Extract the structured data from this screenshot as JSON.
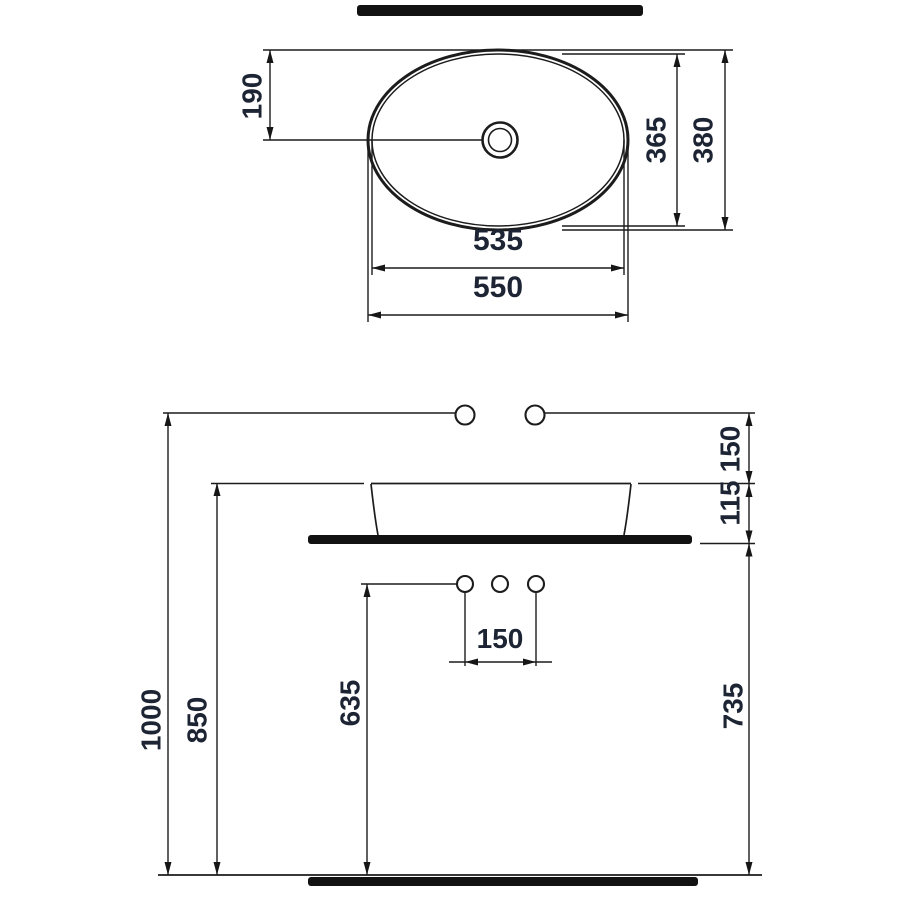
{
  "drawing": {
    "description": "Technical dimension drawing of an oval countertop wash basin, plan view and front elevation",
    "units": "mm",
    "plan_view": {
      "basin_outer_width": "550",
      "basin_inner_width": "535",
      "basin_outer_depth": "380",
      "basin_inner_depth": "365",
      "tap_hole_offset_from_front": "190"
    },
    "front_view": {
      "wall_fixture_height": "1000",
      "basin_rim_height": "850",
      "supply_holes_height": "635",
      "counter_underside_height": "735",
      "fixture_above_rim": "150",
      "rim_above_counter_underside": "115",
      "supply_hole_spacing": "150"
    }
  }
}
